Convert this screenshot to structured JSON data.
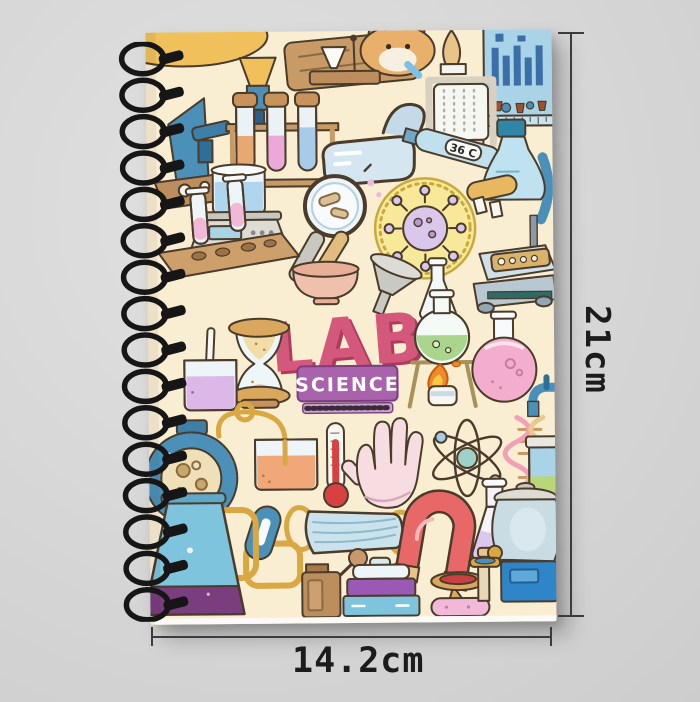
{
  "scene": {
    "background_color": "#D6D6D6"
  },
  "notebook": {
    "title": "LAB",
    "subtitle": "SCIENCE",
    "thermometer_reading": "36 C",
    "cover_color": "#F9EDD2",
    "title_color": "#D4577C",
    "title_shadow_color": "#B03A5E",
    "subtitle_badge_color": "#A863AC",
    "spiral_color": "#161616",
    "cover_icons": [
      "microscope",
      "wooden-sign",
      "hamster",
      "funnel-stand",
      "periodic-chart",
      "eyewash-station",
      "test-tube-rack",
      "safety-goggles",
      "digital-thermometer",
      "lab-scale",
      "magnifying-glass",
      "virus-badge",
      "flask-scope",
      "hot-plate",
      "tube-stand",
      "mortar-pestle",
      "funnel",
      "small-flask",
      "hourglass",
      "burner-flask",
      "round-flask",
      "stir-beaker",
      "centrifuge",
      "orange-beaker",
      "thermometer",
      "lab-glove",
      "atom",
      "dna-helix",
      "faucet",
      "canister",
      "face-mask",
      "horseshoe-magnet",
      "erlenmeyer-flask",
      "clamp",
      "filter-flask",
      "grinder",
      "sample-boxes",
      "specimen-jar",
      "dispenser-jar"
    ]
  },
  "annotations": {
    "height_label": "21cm",
    "width_label": "14.2cm",
    "line_color": "#3C3C3C"
  }
}
